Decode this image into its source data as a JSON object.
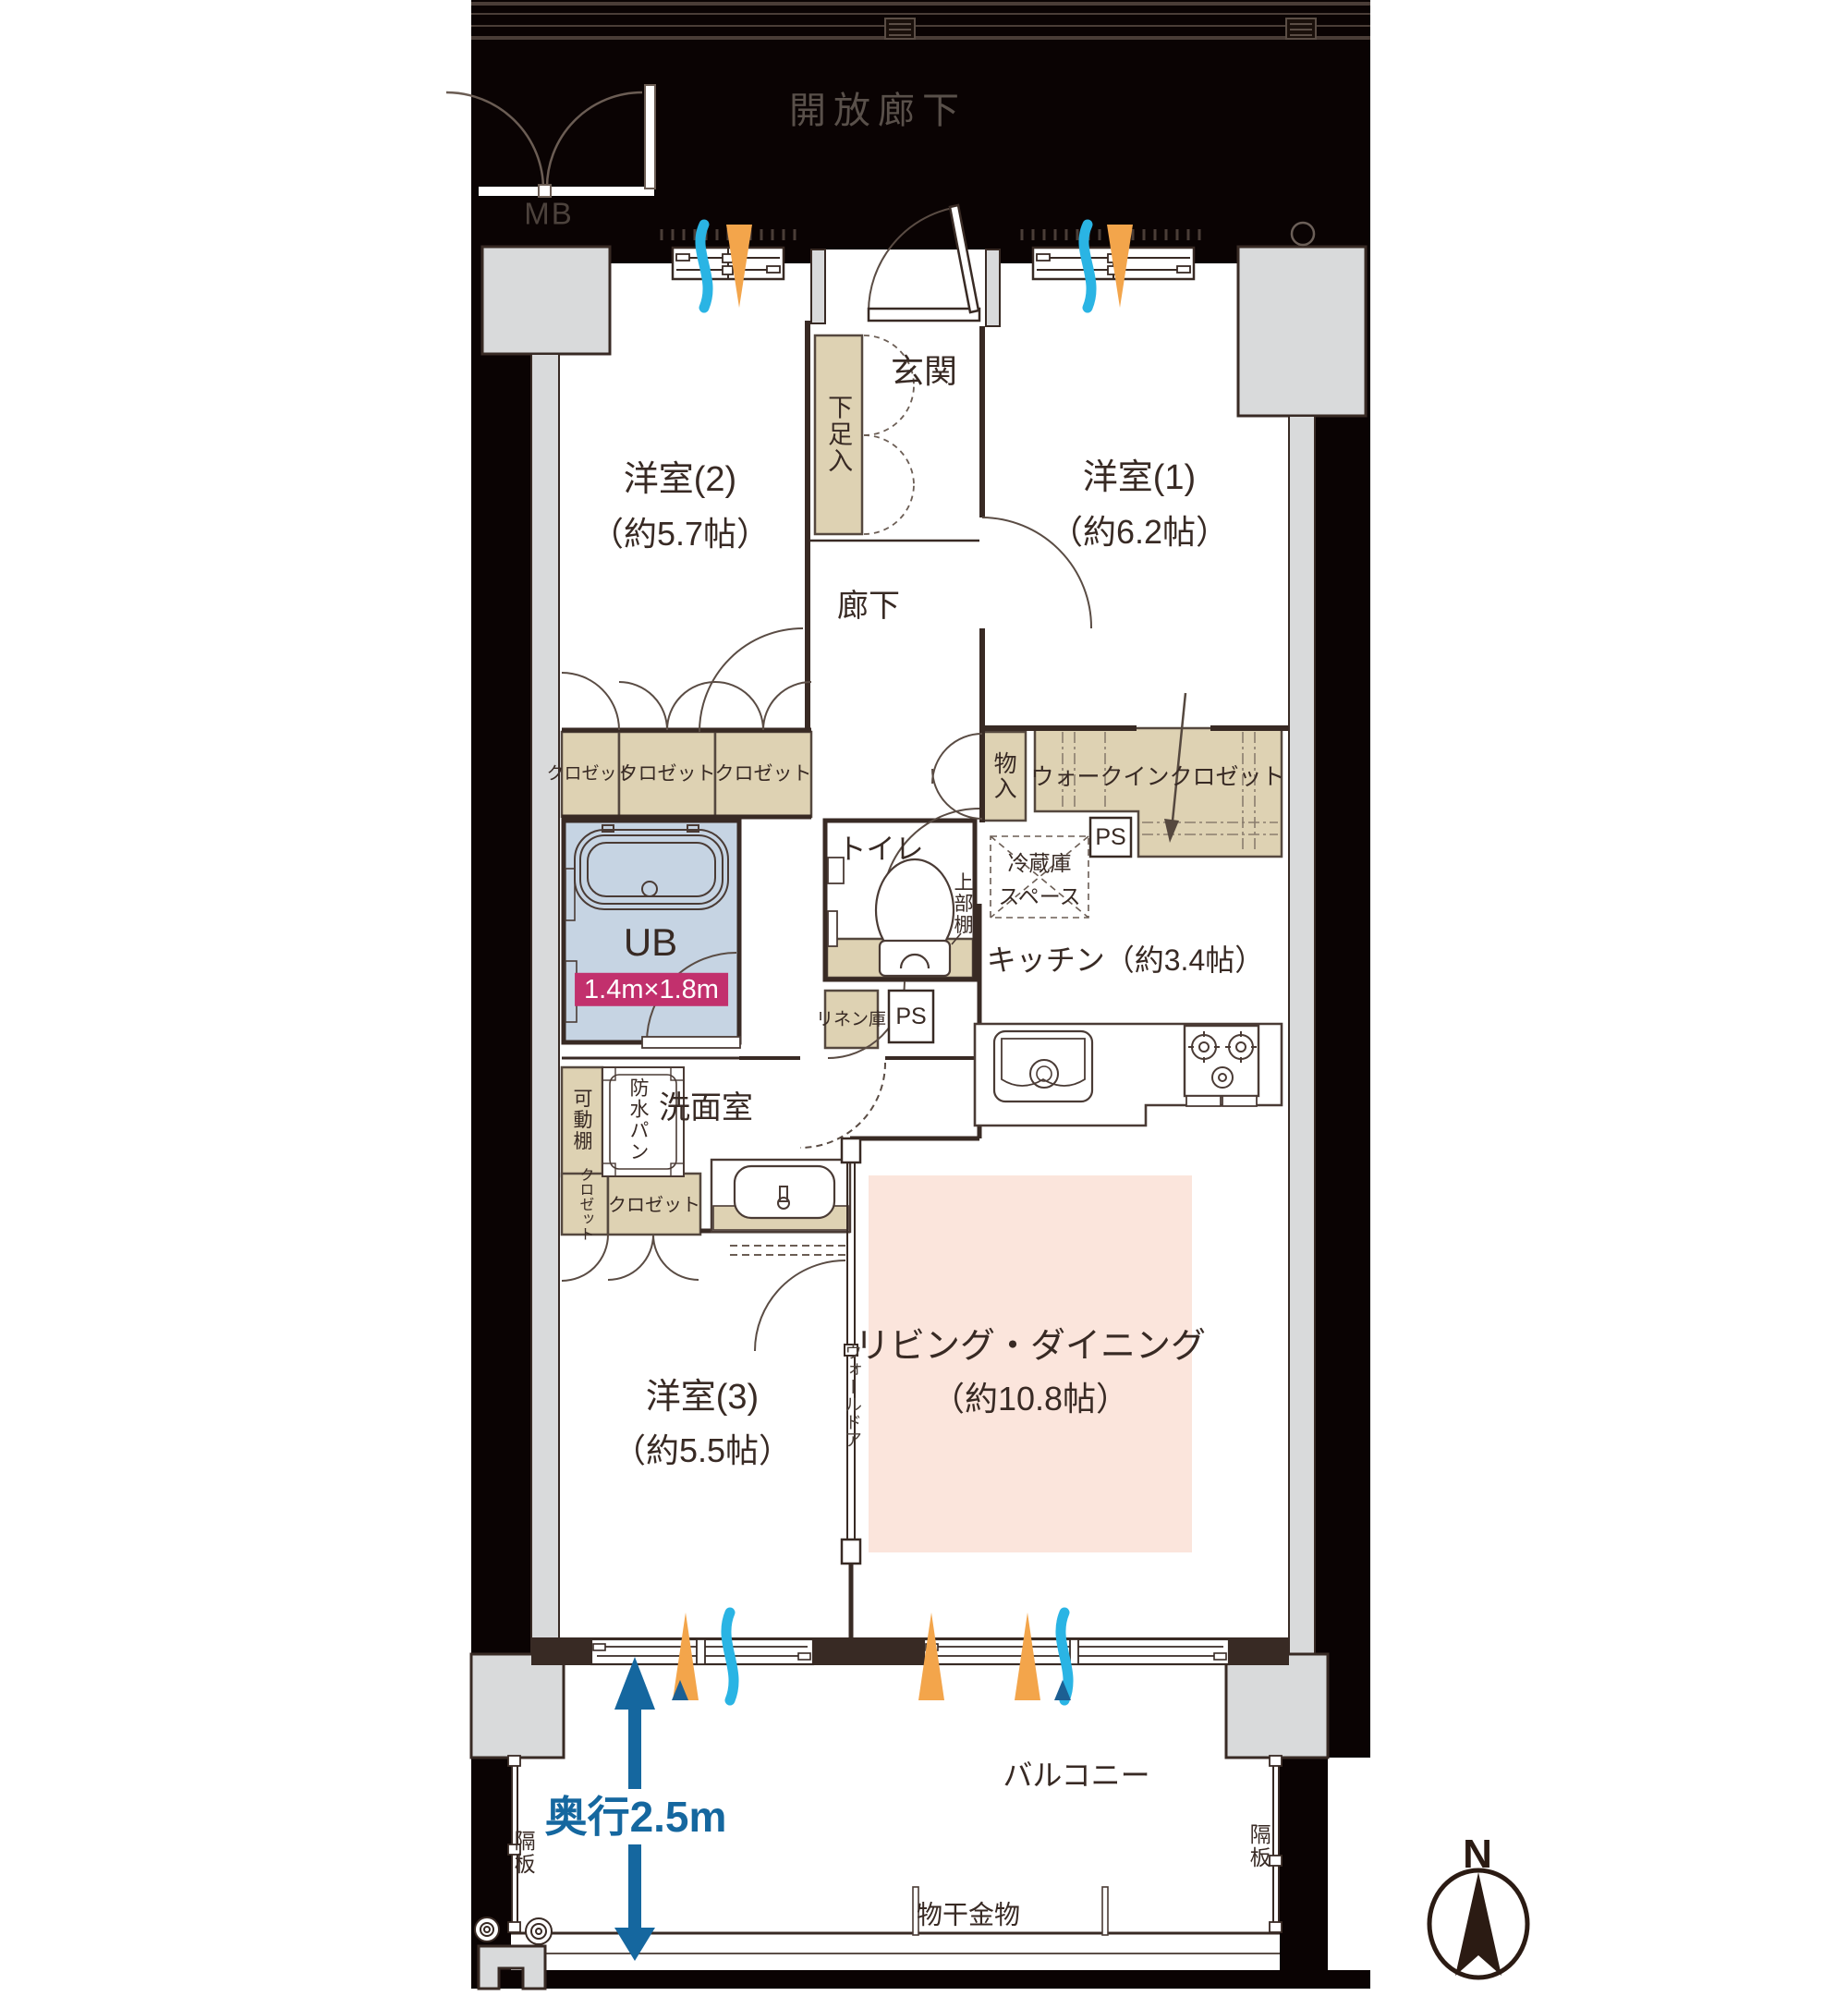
{
  "labels": {
    "corridor_open": "開放廊下",
    "meter_box": "MB",
    "genkan": "玄関",
    "shoe_box": "下足入",
    "hallway": "廊下",
    "room2": {
      "name": "洋室(2)",
      "size": "（約5.7帖）"
    },
    "room1": {
      "name": "洋室(1)",
      "size": "（約6.2帖）"
    },
    "room3": {
      "name": "洋室(3)",
      "size": "（約5.5帖）"
    },
    "living_dining": {
      "name": "リビング・ダイニング",
      "size": "（約10.8帖）"
    },
    "kitchen": "キッチン（約3.4帖）",
    "closets": [
      "クロゼット",
      "クロゼット",
      "クロゼット"
    ],
    "storage": "物入",
    "walk_in_closet": "ウォークインクロゼット",
    "ps1": "PS",
    "ps2": "PS",
    "fridge_line1": "冷蔵庫",
    "fridge_line2": "スペース",
    "toilet": "トイレ",
    "upper_shelf": "上部棚",
    "unit_bath": "UB",
    "unit_bath_size": "1.4m×1.8m",
    "linen": "リネン庫",
    "washroom": "洗面室",
    "movable_shelf": "可動棚",
    "waterproof_pan": "防水パン",
    "closet3_vertical": "クロゼット",
    "closet3_horizontal": "クロゼット",
    "wall_door": "ウォールドア",
    "balcony": "バルコニー",
    "balcony_depth": "奥行2.5m",
    "partition_left": "隔板",
    "partition_right": "隔板",
    "laundry_hardware": "物干金物",
    "north": "N"
  },
  "colors": {
    "outline_dark_brown": "#382a24",
    "backdrop_black": "#0a0303",
    "concrete_gray": "#d9dadb",
    "storage_tan": "#ded2b3",
    "bath_blue": "#c6d4e3",
    "living_pink": "#fbe5dc",
    "size_badge_magenta": "#c2306d",
    "dimension_blue": "#15679f",
    "airflow_cyan": "#2ab4e4",
    "airflow_orange": "#f3a54b",
    "airflow_deep_blue": "#1c5f93",
    "corridor_text_gray": "#59504a"
  }
}
